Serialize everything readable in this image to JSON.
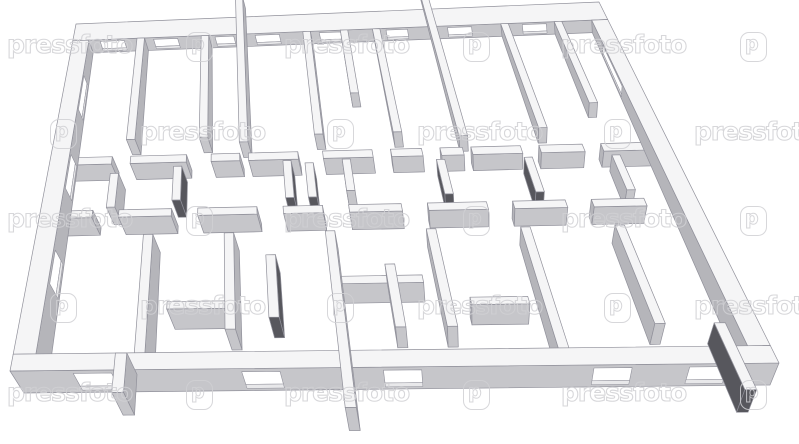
{
  "watermark": {
    "text": "pressfoto",
    "logo_glyph": "p",
    "stroke_color": "#d0d0d4",
    "rows": [
      {
        "y": 30,
        "texts": [
          7,
          284,
          561
        ],
        "logos": [
          186,
          463,
          740
        ]
      },
      {
        "y": 117,
        "texts": [
          140,
          417,
          694
        ],
        "logos": [
          50,
          327,
          604
        ]
      },
      {
        "y": 204,
        "texts": [
          7,
          284,
          561
        ],
        "logos": [
          186,
          463,
          740
        ]
      },
      {
        "y": 291,
        "texts": [
          140,
          417,
          694
        ],
        "logos": [
          50,
          327,
          604
        ]
      },
      {
        "y": 378,
        "texts": [
          7,
          284,
          561
        ],
        "logos": [
          186,
          463,
          740
        ]
      }
    ]
  },
  "scene": {
    "background": "#ffffff",
    "plan_width": 100,
    "plan_depth": 62,
    "camera_u": 45,
    "floor_quad": [
      [
        80,
        36
      ],
      [
        600,
        14
      ],
      [
        770,
        385
      ],
      [
        24,
        393
      ]
    ],
    "top_quad": [
      [
        76,
        24
      ],
      [
        599,
        2
      ],
      [
        779,
        363
      ],
      [
        10,
        371
      ]
    ],
    "colors": {
      "wall_top": "#f5f5f6",
      "face_side": "#b5b5ba",
      "face_front": "#c6c6ca",
      "face_dark": "#57575d",
      "window_sill": "#e8e8ea",
      "stroke": "#90909a"
    },
    "walls": [
      {
        "b": [
          0,
          0,
          100,
          3
        ],
        "winface": "s",
        "win": [
          [
            5,
            9.5
          ],
          [
            15,
            19.5
          ],
          [
            26.5,
            30
          ],
          [
            34,
            38.5
          ],
          [
            46,
            50
          ],
          [
            58.5,
            62.5
          ],
          [
            70,
            74.5
          ],
          [
            84,
            88.5
          ]
        ]
      },
      {
        "b": [
          12,
          3,
          13.4,
          21
        ]
      },
      {
        "b": [
          24,
          3,
          25.4,
          21
        ]
      },
      {
        "b": [
          30.6,
          -3.5,
          32,
          22
        ]
      },
      {
        "b": [
          43,
          3,
          44.4,
          21
        ]
      },
      {
        "b": [
          50,
          3,
          51.4,
          14
        ]
      },
      {
        "b": [
          56,
          3,
          57.4,
          21
        ]
      },
      {
        "b": [
          66.6,
          -3.5,
          68,
          22
        ]
      },
      {
        "b": [
          80,
          3,
          81.4,
          21
        ]
      },
      {
        "b": [
          90,
          3,
          91.4,
          17
        ]
      },
      {
        "b": [
          3,
          24,
          10,
          25.3
        ]
      },
      {
        "b": [
          13,
          24,
          22,
          25.3
        ]
      },
      {
        "b": [
          26,
          24,
          30.6,
          25.3
        ]
      },
      {
        "b": [
          32,
          24,
          40,
          25.3
        ]
      },
      {
        "b": [
          44,
          24,
          52,
          25.3
        ]
      },
      {
        "b": [
          55,
          24,
          60,
          25.3
        ]
      },
      {
        "b": [
          63,
          24,
          66.6,
          25.3
        ]
      },
      {
        "b": [
          68,
          24,
          76,
          25.3
        ]
      },
      {
        "b": [
          79,
          24,
          86,
          25.3
        ]
      },
      {
        "b": [
          89,
          24,
          97,
          25.3
        ]
      },
      {
        "b": [
          20,
          26,
          21.3,
          32
        ],
        "dark": true
      },
      {
        "b": [
          37.5,
          25.5,
          38.8,
          32
        ],
        "dark": true
      },
      {
        "b": [
          41,
          26,
          42.3,
          32
        ],
        "dark": true
      },
      {
        "b": [
          47,
          25.5,
          48.3,
          31
        ]
      },
      {
        "b": [
          62,
          26,
          63.3,
          32
        ],
        "dark": true
      },
      {
        "b": [
          76,
          26,
          77.3,
          32
        ],
        "dark": true
      },
      {
        "b": [
          10,
          27,
          11.3,
          33
        ]
      },
      {
        "b": [
          90,
          26,
          91.3,
          32
        ]
      },
      {
        "b": [
          3,
          33.5,
          8,
          34.8
        ]
      },
      {
        "b": [
          12,
          33.5,
          20,
          34.8
        ]
      },
      {
        "b": [
          24,
          33.5,
          33,
          34.8
        ]
      },
      {
        "b": [
          37,
          33.5,
          43,
          34.8
        ]
      },
      {
        "b": [
          47,
          33.5,
          55,
          34.8
        ]
      },
      {
        "b": [
          59,
          33.5,
          68,
          34.8
        ]
      },
      {
        "b": [
          72,
          33.5,
          80,
          34.8
        ]
      },
      {
        "b": [
          84,
          33.5,
          92,
          34.8
        ]
      },
      {
        "b": [
          34,
          42,
          35.4,
          53
        ],
        "dark": true
      },
      {
        "b": [
          16,
          38,
          17.4,
          59
        ]
      },
      {
        "b": [
          28,
          38,
          29.4,
          55
        ]
      },
      {
        "b": [
          51,
          44,
          52.4,
          55
        ]
      },
      {
        "b": [
          58,
          38,
          59.4,
          55
        ]
      },
      {
        "b": [
          72,
          38,
          73.4,
          59
        ]
      },
      {
        "b": [
          86,
          38,
          87.4,
          55
        ]
      },
      {
        "b": [
          44.4,
          46,
          56,
          47.3
        ]
      },
      {
        "b": [
          20,
          50,
          28,
          51.3
        ]
      },
      {
        "b": [
          62,
          50,
          70,
          51.3
        ]
      },
      {
        "b": [
          0,
          3,
          3,
          59
        ],
        "winface": "e",
        "win": [
          [
            9,
            15
          ],
          [
            23,
            29
          ],
          [
            40,
            46
          ]
        ]
      },
      {
        "b": [
          97,
          3,
          100,
          59
        ],
        "winface": "w",
        "win": [
          [
            7,
            14
          ]
        ]
      },
      {
        "b": [
          0,
          59,
          100,
          62
        ],
        "winface": "s",
        "win": [
          [
            8,
            13
          ],
          [
            30,
            35
          ],
          [
            48.5,
            53.5
          ],
          [
            76,
            81
          ],
          [
            88.5,
            93.5
          ]
        ]
      },
      {
        "b": [
          13.5,
          59,
          15,
          66
        ]
      },
      {
        "b": [
          43,
          38,
          44.4,
          69
        ]
      },
      {
        "b": [
          94,
          55,
          95.5,
          66.5
        ],
        "dark": true
      }
    ]
  }
}
